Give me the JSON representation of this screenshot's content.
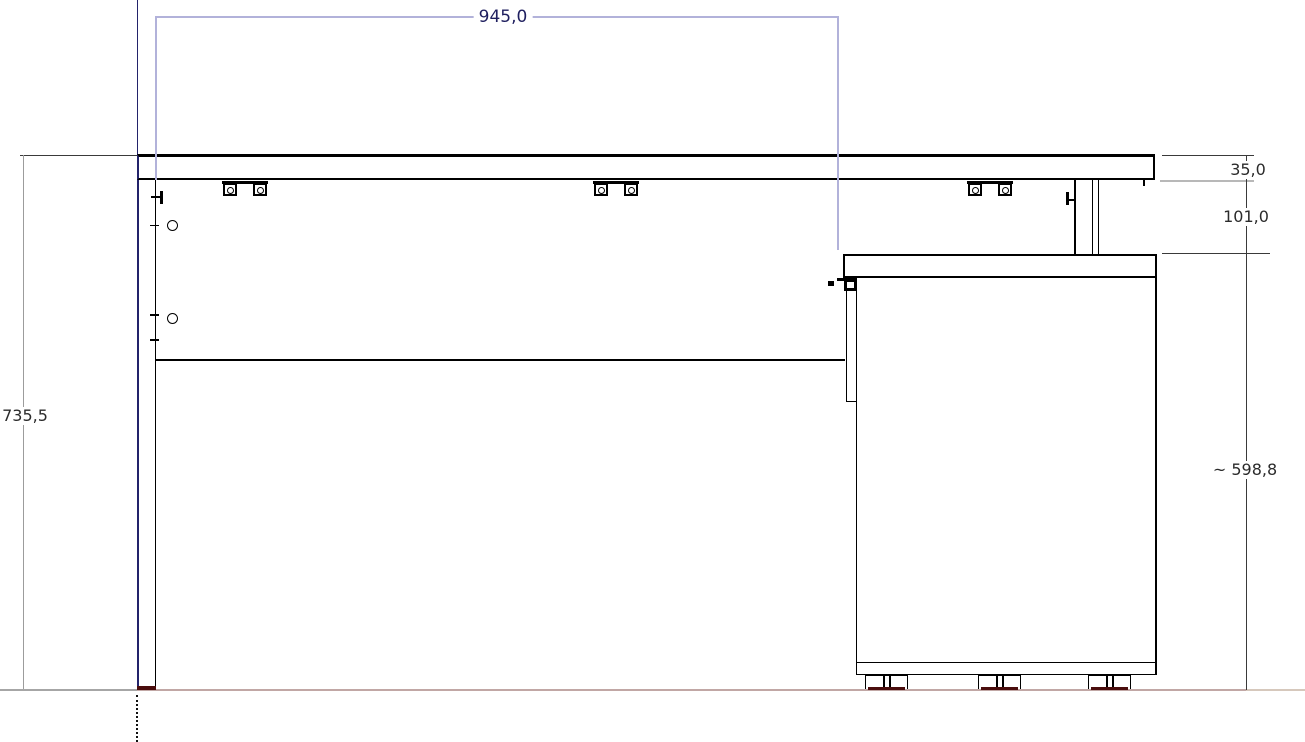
{
  "drawing": {
    "kind": "technical elevation drawing of a desk with pedestal cabinet"
  },
  "dimensions": {
    "top_width": {
      "label": "945,0",
      "value": 945.0
    },
    "overall_height": {
      "label": "735,5",
      "value": 735.5
    },
    "worktop_thickness": {
      "label": "35,0",
      "value": 35.0
    },
    "clearance_under_top": {
      "label": "101,0",
      "value": 101.0
    },
    "cabinet_height": {
      "label": "~ 598,8",
      "value": 598.8
    }
  },
  "colors": {
    "dim_blue_line": "#b2b2da",
    "dim_blue_text": "#1f1f5f",
    "dim_gray_line": "#9c9c9c",
    "dim_dark_line": "#3a3a3a",
    "dim_text": "#2b2b2b",
    "outline_black": "#000000",
    "edge_navy": "#23236b",
    "contact_red": "#4a0d0d",
    "floor_gray": "#a6a6a6",
    "floor_rose": "#c1a7a5",
    "floor_tan": "#d6c8bc"
  }
}
